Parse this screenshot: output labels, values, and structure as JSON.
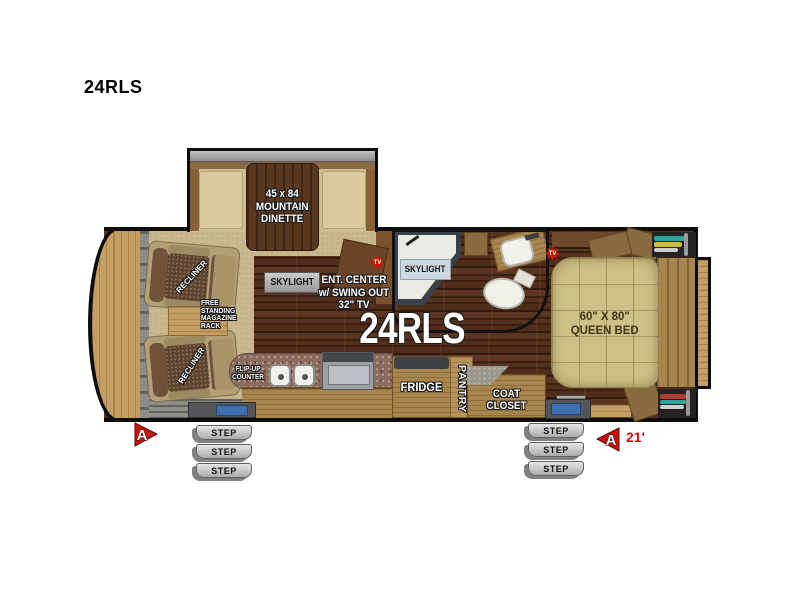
{
  "title": "24RLS",
  "floorplan": {
    "model_text": "24RLS",
    "length_text": "21'",
    "arrow_label": "A",
    "tv_label": "TV",
    "dinette_lines": [
      "45 x 84",
      "MOUNTAIN",
      "DINETTE"
    ],
    "living": {
      "skylight_label": "SKYLIGHT",
      "ent_center_lines": [
        "ENT. CENTER",
        "w/ SWING OUT",
        "32\" TV"
      ],
      "recliner_label": "RECLINER",
      "magazine_rack_lines": [
        "FREE",
        "STANDING",
        "MAGAZINE",
        "RACK"
      ]
    },
    "kitchen": {
      "flip_up_counter_lines": [
        "FLIP-UP",
        "COUNTER"
      ],
      "fridge_label": "FRIDGE",
      "pantry_label": "PANTRY",
      "coat_closet_lines": [
        "COAT",
        "CLOSET"
      ]
    },
    "bathroom": {
      "skylight_label": "SKYLIGHT"
    },
    "bedroom": {
      "bed_lines": [
        "60\" X 80\"",
        "QUEEN BED"
      ]
    },
    "steps_label": "STEP",
    "colors": {
      "accent_red": "#c8140a",
      "outline_black": "#0d0d0d",
      "carpet_tan": "#c9b88d",
      "wood_floor": "#44281a",
      "cabinet_wood": "#a9854e",
      "bed_tan": "#cfc089",
      "step_gray": "#c9c9c9"
    }
  }
}
